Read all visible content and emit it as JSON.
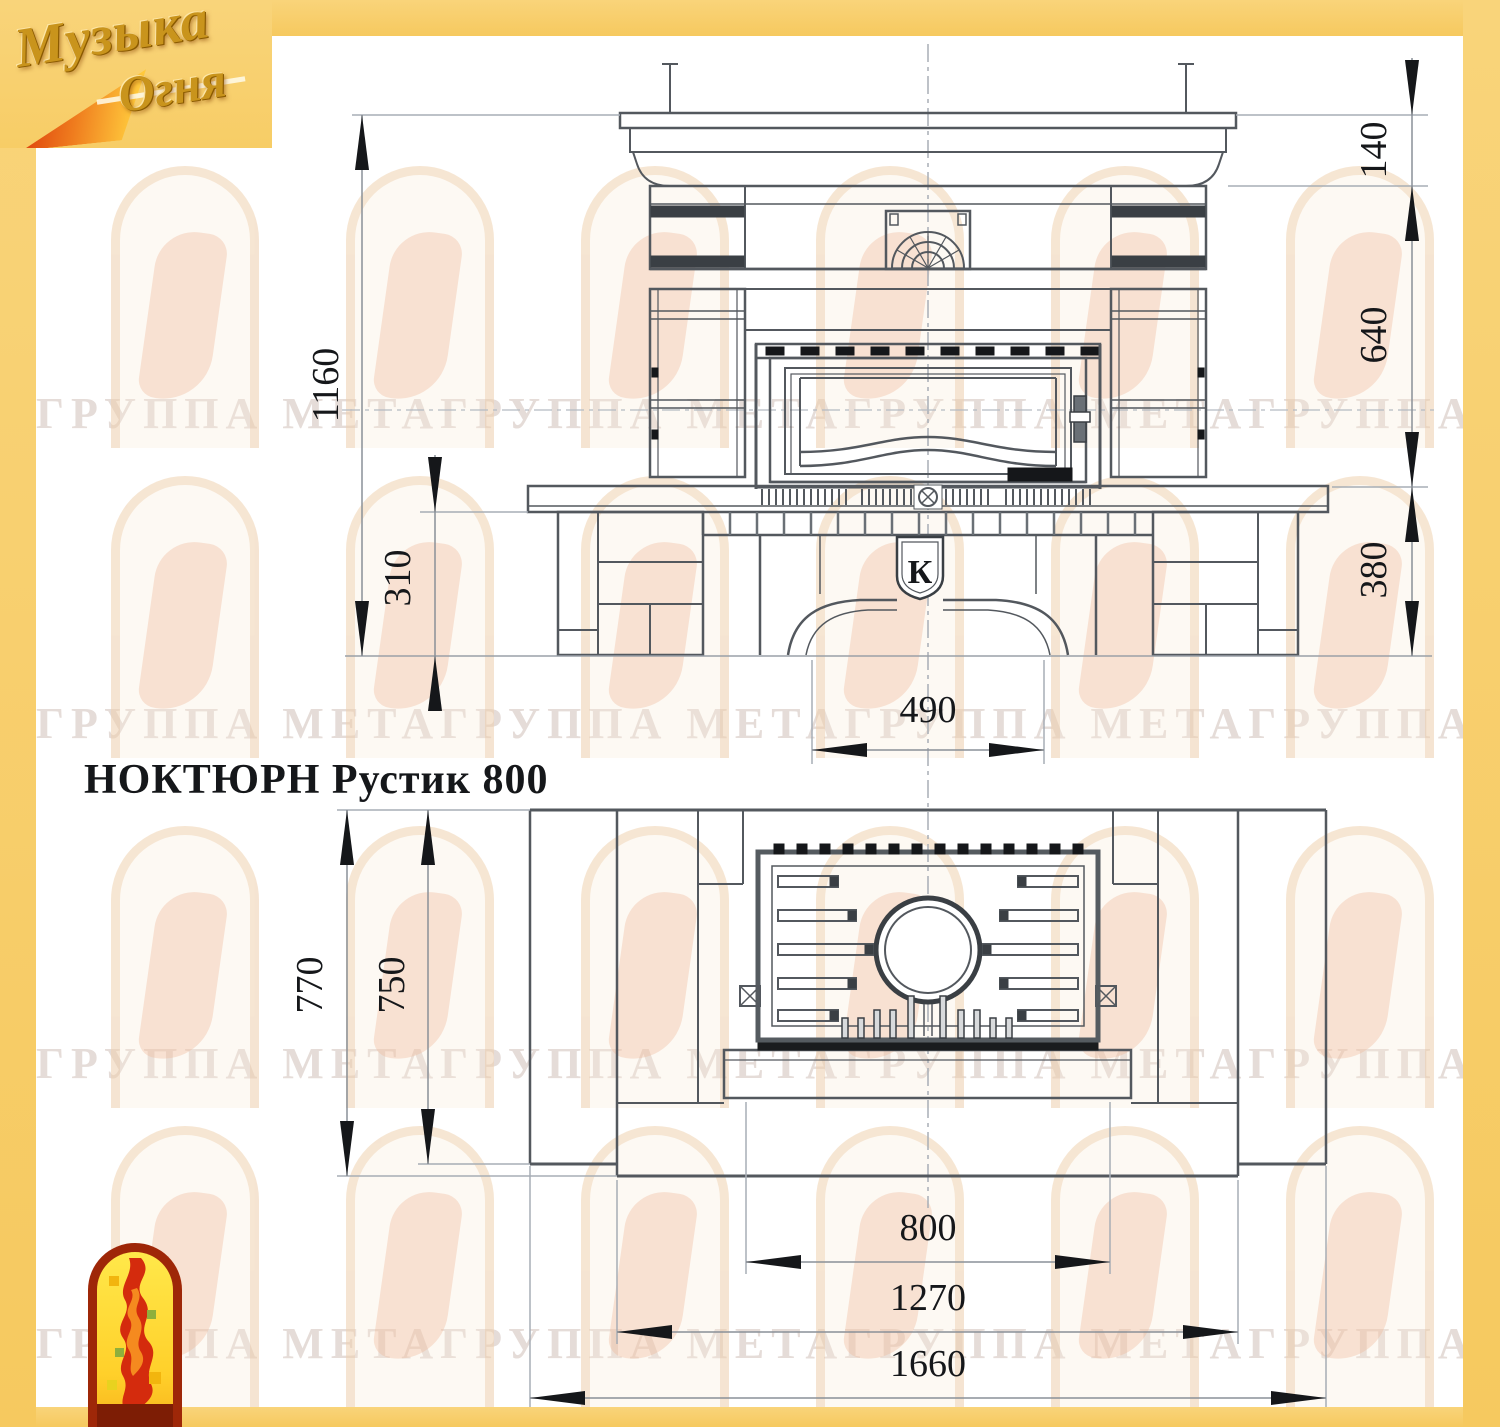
{
  "title": {
    "text": "НОКТЮРН Рустик 800"
  },
  "brand": {
    "line1": "Музыка",
    "line2": "Огня"
  },
  "watermark": {
    "text": "ГРУППА МЕТАГРУППА МЕТАГРУППА МЕТАГРУППА МЕТАГРУППА МЕТА"
  },
  "emblem": {
    "letter": "К"
  },
  "dimensions": {
    "front": [
      {
        "id": "total-height",
        "value": "1160"
      },
      {
        "id": "plinth-height",
        "value": "310"
      },
      {
        "id": "cornice-height",
        "value": "140"
      },
      {
        "id": "firebox-height",
        "value": "640"
      },
      {
        "id": "bench-height",
        "value": "380"
      },
      {
        "id": "arch-width",
        "value": "490"
      }
    ],
    "plan": [
      {
        "id": "depth-total",
        "value": "770"
      },
      {
        "id": "depth-inner",
        "value": "750"
      },
      {
        "id": "insert-width",
        "value": "800"
      },
      {
        "id": "body-width",
        "value": "1270"
      },
      {
        "id": "total-width",
        "value": "1660"
      }
    ]
  },
  "colors": {
    "frame_yellow": "#f8cf6d",
    "line_main": "#53585e",
    "line_dark": "#3a3f44",
    "line_light": "#9aa0a8",
    "ink_black": "#15171a",
    "brand_gold": "#c9941c",
    "flame_red": "#d42b0d",
    "flame_orange": "#f58a1f"
  }
}
